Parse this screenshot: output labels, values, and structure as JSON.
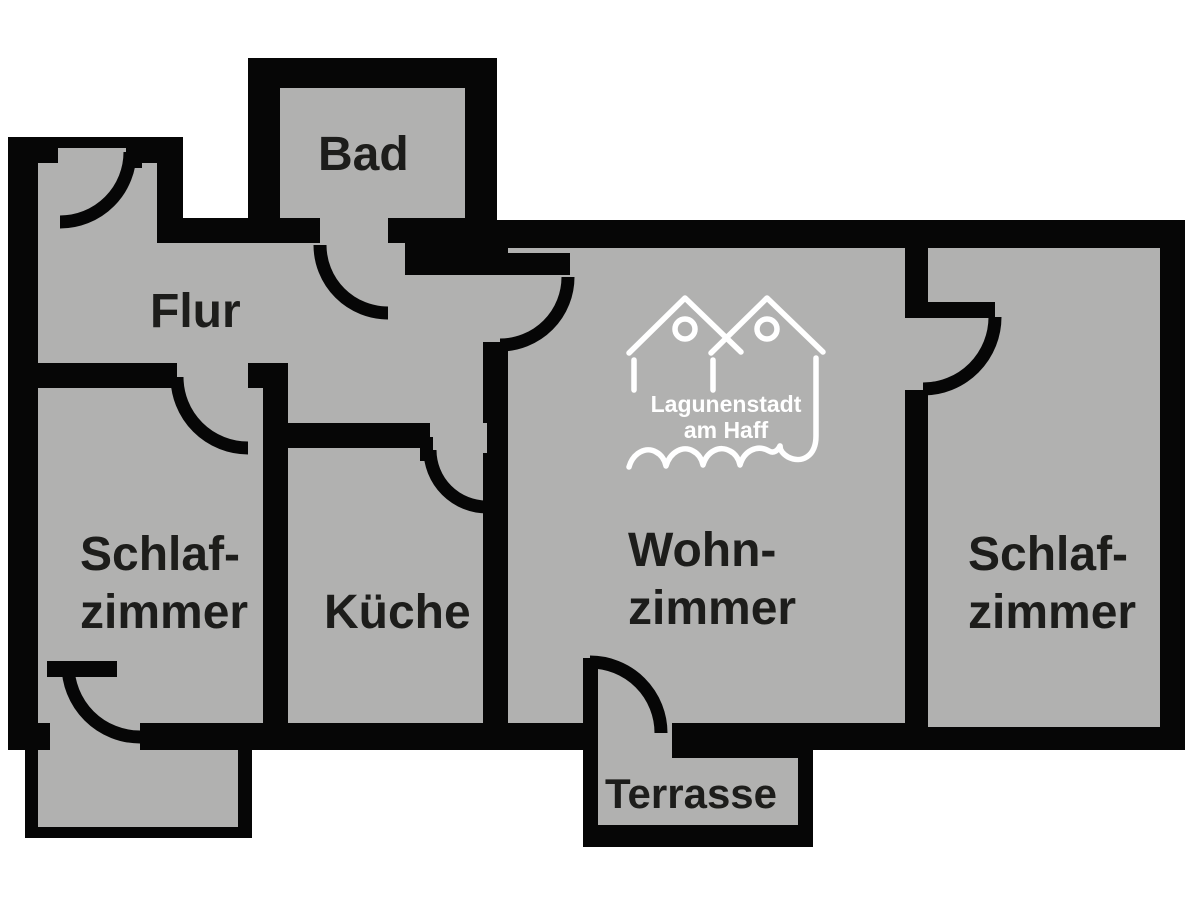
{
  "floorplan": {
    "title": "Apartment floor plan",
    "rooms": {
      "bad": {
        "label": "Bad"
      },
      "flur": {
        "label": "Flur"
      },
      "schlafzimmer_links": {
        "line1": "Schlaf-",
        "line2": "zimmer"
      },
      "kueche": {
        "label": "Küche"
      },
      "wohnzimmer": {
        "line1": "Wohn-",
        "line2": "zimmer"
      },
      "schlafzimmer_rechts": {
        "line1": "Schlaf-",
        "line2": "zimmer"
      },
      "terrasse": {
        "label": "Terrasse"
      }
    },
    "logo": {
      "name_line1": "Lagunenstadt",
      "name_line2": "am Haff"
    },
    "colors": {
      "background": "#ffffff",
      "floor_gray": "#b1b1b0",
      "wall_black": "#060606",
      "label_text": "#1d1d1b",
      "logo_white": "#ffffff"
    }
  }
}
